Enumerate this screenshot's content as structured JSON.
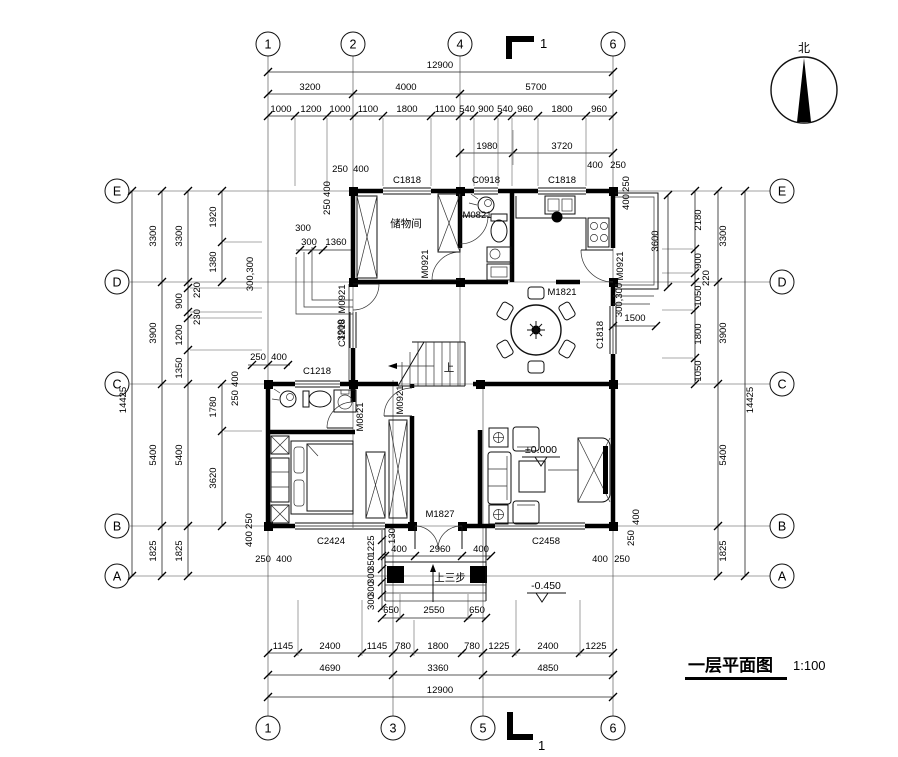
{
  "title": {
    "text": "一层平面图",
    "scale": "1:100"
  },
  "north": {
    "label": "北"
  },
  "section": {
    "top": "1",
    "bottom": "1"
  },
  "axes": {
    "top": [
      "1",
      "2",
      "4",
      "6"
    ],
    "bottom": [
      "1",
      "3",
      "5",
      "6"
    ],
    "left": [
      "E",
      "D",
      "C",
      "B",
      "A"
    ],
    "right": [
      "E",
      "D",
      "C",
      "B",
      "A"
    ]
  },
  "rooms": {
    "storage": "储物间"
  },
  "levels": {
    "main": "±0.000",
    "porch": "-0.450",
    "steps_up": "上三步",
    "stair_up": "上"
  },
  "openings": {
    "m0821": "M0821",
    "m0921": "M0921",
    "m1821": "M1821",
    "m1827": "M1827",
    "c0918": "C0918",
    "c1218": "C1218",
    "c1818": "C1818",
    "c2424": "C2424",
    "c2458": "C2458"
  },
  "dims_top": {
    "total": "12900",
    "spans": [
      "3200",
      "4000",
      "5700"
    ],
    "detail": [
      "1000",
      "1200",
      "1000",
      "1100",
      "1800",
      "1100",
      "540",
      "900",
      "540",
      "960",
      "1800",
      "960"
    ],
    "partial": [
      "1980",
      "3720"
    ]
  },
  "dims_bottom": {
    "detail": [
      "1145",
      "2400",
      "1145",
      "780",
      "1800",
      "780",
      "1225",
      "2400",
      "1225"
    ],
    "spans": [
      "4690",
      "3360",
      "4850"
    ],
    "total": "12900",
    "porch": [
      "650",
      "2550",
      "650"
    ],
    "porch_door": [
      "400",
      "2960",
      "400"
    ],
    "porch_side": [
      "1225",
      "350",
      "300",
      "300",
      "300"
    ],
    "d130": "130"
  },
  "dims_left": {
    "total": "14425",
    "spans": [
      "3300",
      "3900",
      "5400",
      "1825"
    ],
    "col2": [
      "3300",
      "220",
      "900",
      "230",
      "1200",
      "1350",
      "5400",
      "1825"
    ],
    "inner": [
      "1920",
      "1380",
      "1780",
      "3620"
    ],
    "steps": [
      "300",
      "300",
      "1360"
    ],
    "steps_side": "300,300",
    "interior": "3900",
    "cornerC_h": [
      "250",
      "400"
    ],
    "cornerC_v": [
      "400",
      "250"
    ],
    "cornerB_h": [
      "250",
      "400"
    ],
    "cornerB_v": [
      "250",
      "400"
    ],
    "cornerTop_h": [
      "250",
      "400"
    ],
    "cornerTop_v": [
      "400",
      "250"
    ]
  },
  "dims_right": {
    "total": "14425",
    "spans": [
      "3300",
      "3900",
      "5400",
      "1825"
    ],
    "inner": [
      "2180",
      "900",
      "220",
      "1050",
      "1800",
      "1050"
    ],
    "balcony": "3600",
    "balcony_w": "1500",
    "side": "300,300",
    "cornerTop_h": [
      "400",
      "250"
    ],
    "cornerTop_v": [
      "250",
      "400"
    ],
    "cornerB_v": [
      "400",
      "250"
    ],
    "cornerB_h": [
      "400",
      "250"
    ]
  }
}
